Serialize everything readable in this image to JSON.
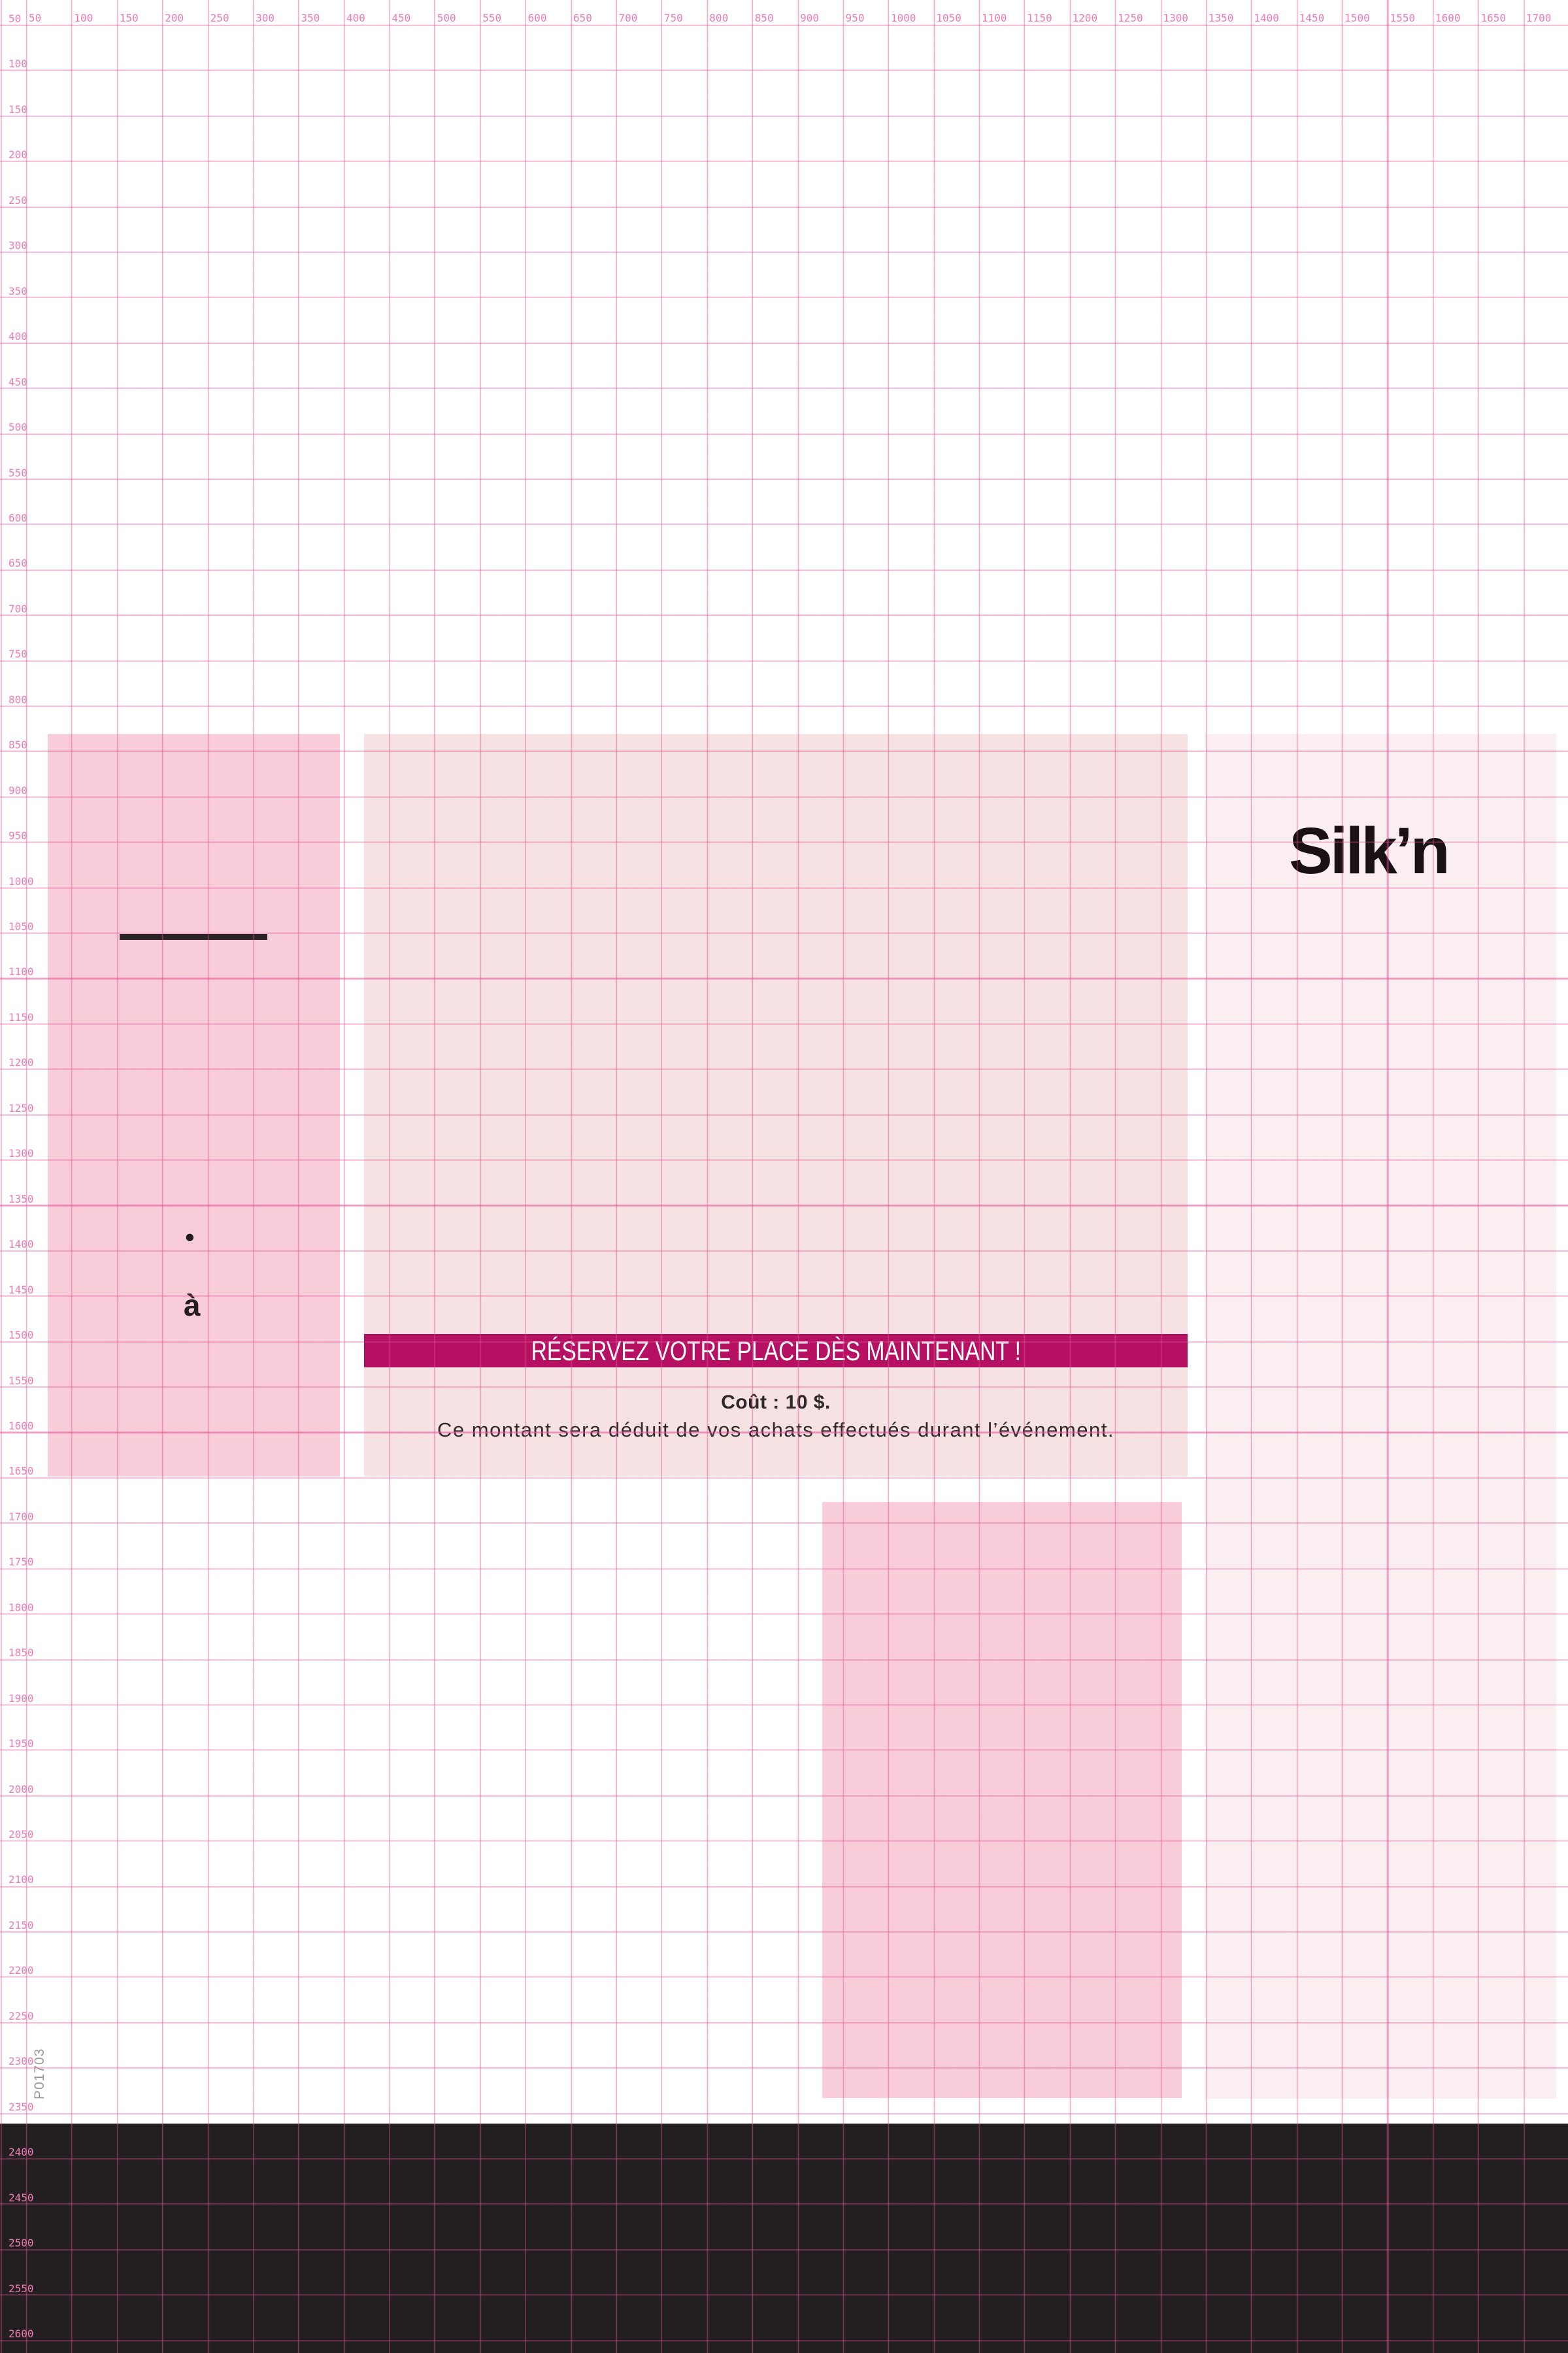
{
  "rulers": {
    "top_labels": [
      50,
      100,
      150,
      200,
      250,
      300,
      350,
      400,
      450,
      500,
      550,
      600,
      650,
      700,
      750,
      800,
      850,
      900,
      950,
      1000,
      1050,
      1100,
      1150,
      1200,
      1250,
      1300,
      1350,
      1400,
      1450,
      1500,
      1550,
      1600,
      1650,
      1700
    ],
    "left_labels": [
      50,
      100,
      150,
      200,
      250,
      300,
      350,
      400,
      450,
      500,
      550,
      600,
      650,
      700,
      750,
      800,
      850,
      900,
      950,
      1000,
      1050,
      1100,
      1150,
      1200,
      1250,
      1300,
      1350,
      1400,
      1450,
      1500,
      1550,
      1600,
      1650,
      1700,
      1750,
      1800,
      1850,
      1900,
      1950,
      2000,
      2050,
      2100,
      2150,
      2200,
      2250,
      2300,
      2350,
      2400,
      2450,
      2500,
      2550,
      2600
    ]
  },
  "marks": {
    "bullet": "•",
    "a_label": "à"
  },
  "silkn": {
    "text": "Silk’n",
    "reg": "®"
  },
  "banner": {
    "text": "RÉSERVEZ VOTRE PLACE DÈS MAINTENANT !",
    "bg_color": "#b61063"
  },
  "pricing": {
    "title": "Coût : 10 $.",
    "subtitle": "Ce montant sera déduit de vos achats effectués durant l’événement."
  },
  "footer": {
    "title": "Duke Tower Compounding Pharmacy",
    "bg_color": "#231f20",
    "logo_letter": "U",
    "logo_colors": {
      "yellow": "#ffd400",
      "orange": "#f07a38",
      "blue": "#1652a4"
    }
  },
  "print_code": "P01703",
  "colors": {
    "grid_line": "#e04f96",
    "ruler_text": "#ee7ab2",
    "block_left": "#f8ccd8",
    "block_center": "#f6e2e2",
    "block_right": "#faeef0",
    "block_bottom": "#f8ccd8",
    "text_dark": "#2e282a"
  }
}
